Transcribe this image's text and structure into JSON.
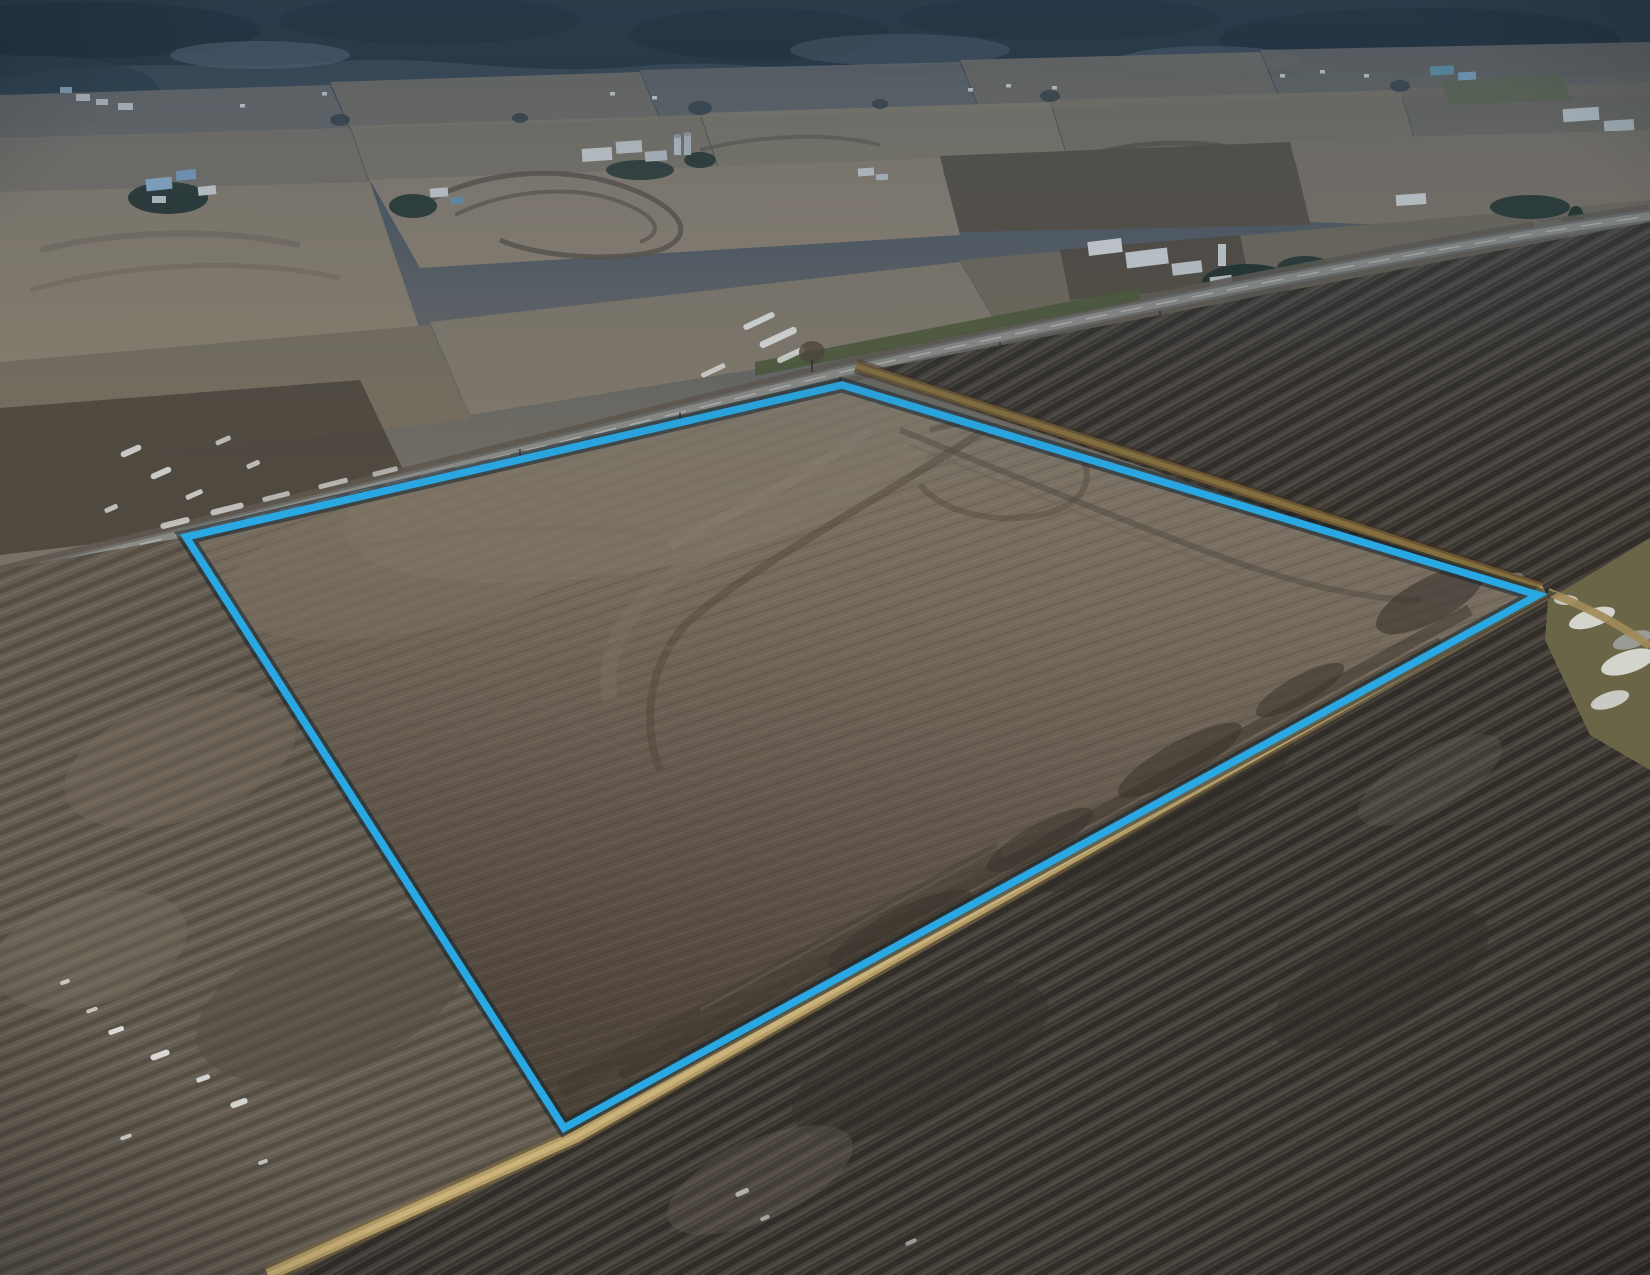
{
  "image": {
    "kind": "aerial-drone-photograph-of-farmland",
    "visible_text": "",
    "boundary_overlay": {
      "points": "186,537 842,385 1538,595 564,1128",
      "line_color": "#29a8e3",
      "shadow_color": "#10222e",
      "line_width": 7.5,
      "shadow_width": 15
    },
    "roads": {
      "highway_path": "M0,578 C300,506 620,428 842,372 C1100,314 1420,248 1650,216",
      "highway_color": "#8b8b86",
      "highway_centerline_color": "#d6d6d0",
      "gravel_road_upper_path": "M856,366 C1080,438 1330,518 1542,588",
      "gravel_road_upper_color": "#6a5432",
      "gravel_road_lower_path": "M1545,591 L575,1137 L268,1275",
      "gravel_road_lower_color": "#b49c66",
      "gravel_road_lower_core_color": "#cdb57c",
      "gravel_road_fork_path": "M1548,592 C1590,608 1622,626 1650,646"
    },
    "palette": {
      "forest_dark": "#1e2d38",
      "forest_darker": "#16242f",
      "haze_blue": "#4f5a66",
      "distant_field_gray": "#6f6d68",
      "distant_field_tan": "#8a7e6a",
      "plowed_dark": "#574e42",
      "parcel_soil_top": "#7b7265",
      "parcel_soil_bottom": "#4b433a",
      "dark_field_southeast": "#45403a",
      "foreground_soil": "#655d51",
      "grass_verge": "#4d5836",
      "waterway_olive": "#6b6547",
      "snow_white": "#eef0ee",
      "ice_gray": "#b7c2c9",
      "building_white": "#d6dadb",
      "roof_blue": "#7fa9c8",
      "roof_teal": "#5f98ab",
      "tree_green": "#26352f"
    }
  }
}
